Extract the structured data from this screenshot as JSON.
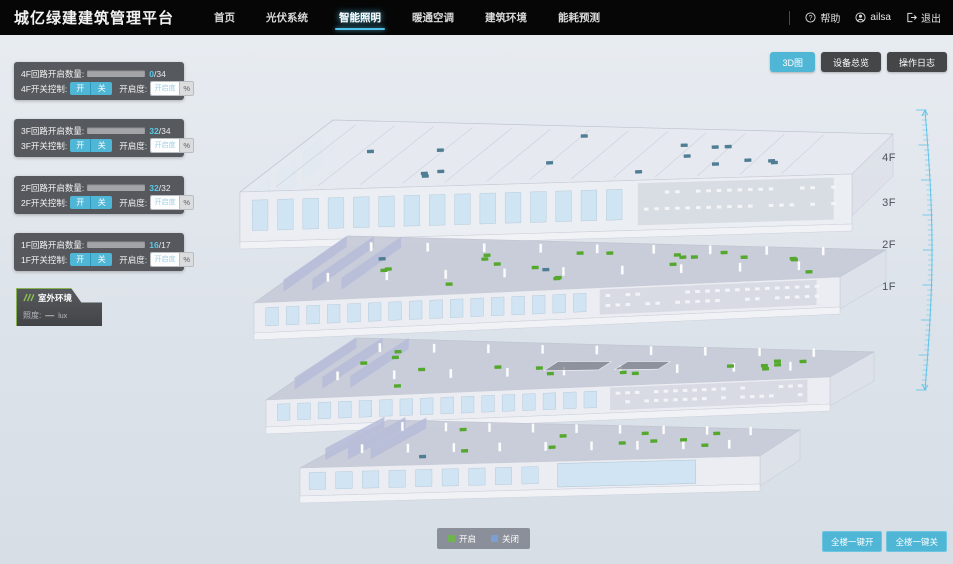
{
  "header": {
    "title": "城亿绿建建筑管理平台",
    "nav": [
      {
        "label": "首页",
        "active": false
      },
      {
        "label": "光伏系统",
        "active": false
      },
      {
        "label": "智能照明",
        "active": true
      },
      {
        "label": "暖通空调",
        "active": false
      },
      {
        "label": "建筑环境",
        "active": false
      },
      {
        "label": "能耗预测",
        "active": false
      }
    ],
    "help_label": "帮助",
    "username": "ailsa",
    "logout_label": "退出"
  },
  "view_buttons": [
    {
      "label": "3D图",
      "active": true
    },
    {
      "label": "设备总览",
      "active": false
    },
    {
      "label": "操作日志",
      "active": false
    }
  ],
  "floor_cards": [
    {
      "circuit_label": "4F回路开启数量:",
      "count_value": "0",
      "count_total": "/34",
      "on": 0,
      "total": 34,
      "switch_label": "4F开关控制:",
      "on_btn": "开",
      "off_btn": "关",
      "dim_label": "开启度:",
      "dim_placeholder": "开启度",
      "percent_suffix": "%"
    },
    {
      "circuit_label": "3F回路开启数量:",
      "count_value": "32",
      "count_total": "/34",
      "on": 32,
      "total": 34,
      "switch_label": "3F开关控制:",
      "on_btn": "开",
      "off_btn": "关",
      "dim_label": "开启度:",
      "dim_placeholder": "开启度",
      "percent_suffix": "%"
    },
    {
      "circuit_label": "2F回路开启数量:",
      "count_value": "32",
      "count_total": "/32",
      "on": 32,
      "total": 32,
      "switch_label": "2F开关控制:",
      "on_btn": "开",
      "off_btn": "关",
      "dim_label": "开启度:",
      "dim_placeholder": "开启度",
      "percent_suffix": "%"
    },
    {
      "circuit_label": "1F回路开启数量:",
      "count_value": "16",
      "count_total": "/17",
      "on": 16,
      "total": 17,
      "switch_label": "1F开关控制:",
      "on_btn": "开",
      "off_btn": "关",
      "dim_label": "开启度:",
      "dim_placeholder": "开启度",
      "percent_suffix": "%"
    }
  ],
  "outdoor": {
    "title": "室外环境",
    "icon": "sun-rays-icon",
    "illuminance_label": "照度:",
    "illuminance_value": "—",
    "illuminance_unit": "lux"
  },
  "building": {
    "marker_on_color": "#55a82e",
    "marker_off_color": "#4e7d94",
    "floors": [
      {
        "label": "4F",
        "markers_on": 0,
        "markers_off": 16
      },
      {
        "label": "3F",
        "markers_on": 20,
        "markers_off": 2
      },
      {
        "label": "2F",
        "markers_on": 16,
        "markers_off": 0
      },
      {
        "label": "1F",
        "markers_on": 10,
        "markers_off": 1
      }
    ]
  },
  "legend": {
    "on_label": "开启",
    "on_color": "#6fb54d",
    "off_label": "关闭",
    "off_color": "#7c9fd3"
  },
  "bulk_buttons": [
    {
      "label": "全楼一键开"
    },
    {
      "label": "全楼一键关"
    }
  ],
  "icons": {
    "header": [
      "help-icon",
      "user-icon",
      "logout-icon"
    ]
  },
  "colors": {
    "accent": "#4fb6d6",
    "header_bg": "#060606",
    "card_bg": "rgba(74,76,80,0.92)"
  }
}
